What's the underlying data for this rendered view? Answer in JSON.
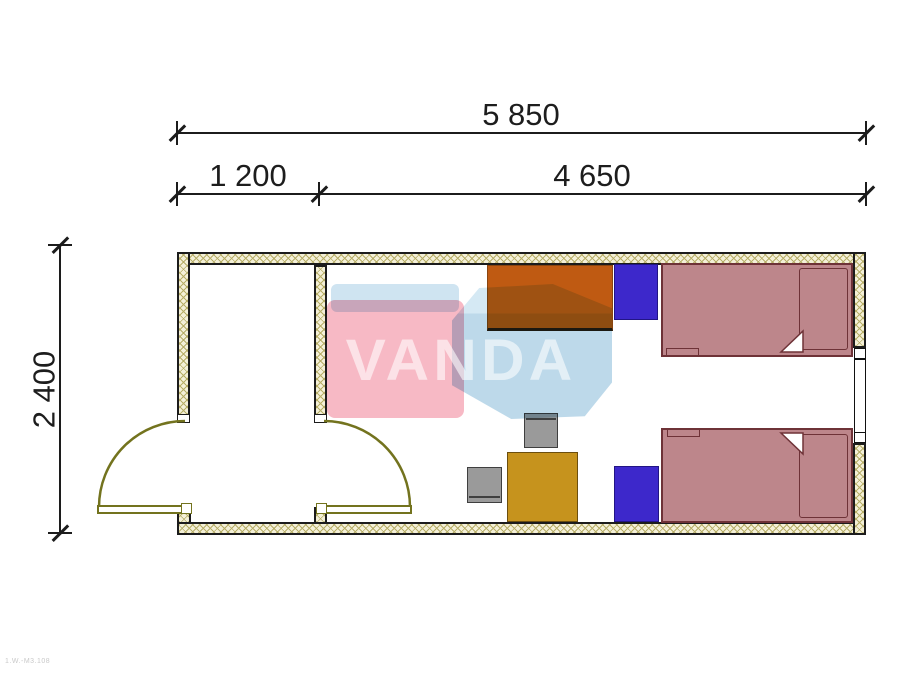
{
  "drawing": {
    "type": "floor-plan",
    "unit": "mm",
    "background": "#ffffff"
  },
  "dimensions": {
    "overall_width": "5 850",
    "hall_width": "1 200",
    "room_width": "4 650",
    "depth": "2 400"
  },
  "watermark": {
    "text": "VANDA",
    "panel_color": "#f7b9c5",
    "cube_color": "#bdd9ea",
    "band_color": "#cfe4f1"
  },
  "footer": {
    "code": "1.W.-M3.108"
  },
  "plan": {
    "rooms": [
      {
        "name": "entrance-hall"
      },
      {
        "name": "bedroom"
      }
    ],
    "colors": {
      "wall_fill": "#f4f0d8",
      "wall_hatch": "#b7ae68",
      "wall_outline": "#1c1c1c",
      "door": "#73731e",
      "wardrobe": "#bf5a12",
      "nightstand": "#3d28cb",
      "bed": "#bd868b",
      "bed_outline": "#6e3237",
      "table": "#c6931d",
      "chair": "#9a9a9a"
    },
    "furniture": [
      {
        "name": "wardrobe"
      },
      {
        "name": "nightstand-top"
      },
      {
        "name": "nightstand-bottom"
      },
      {
        "name": "bed-top"
      },
      {
        "name": "bed-bottom"
      },
      {
        "name": "table"
      },
      {
        "name": "chair-top"
      },
      {
        "name": "chair-left"
      }
    ]
  }
}
